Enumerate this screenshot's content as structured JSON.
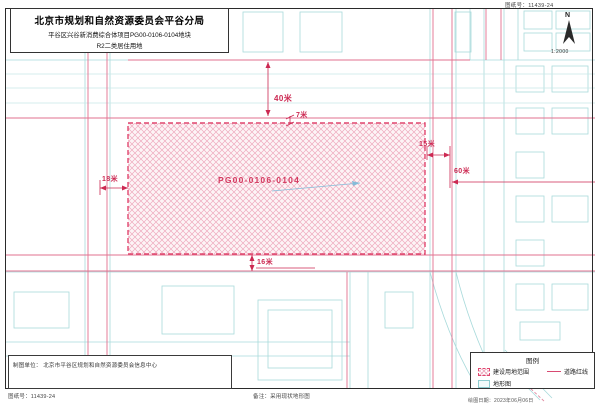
{
  "document": {
    "sheet_no_top": "图纸号：11439-24",
    "title_block": {
      "line1": "北京市规划和自然资源委员会平谷分局",
      "line2": "平谷区兴谷新消费综合体项目PG00-0106-0104地块",
      "line3": "R2二类居住用地"
    },
    "north": {
      "label": "N",
      "scale": "1:2000"
    },
    "map": {
      "parcel_label": "PG00-0106-0104",
      "dimensions": {
        "road_top_width": "40米",
        "strip_top": "7米",
        "road_right_width": "15米",
        "offset_right": "60米",
        "road_left_width": "18米",
        "road_bottom_width": "16米"
      }
    },
    "legend": {
      "title": "图例",
      "items": [
        {
          "label": "建设用地范围"
        },
        {
          "label": "道路红线"
        },
        {
          "label": "地形图"
        }
      ]
    },
    "info_box_text": "制图单位： 北京市平谷区规划和自然资源委员会信息中心",
    "footer": {
      "sheet_no": "图纸号：11439-24",
      "note": "备注：采用现状地形图",
      "date": "绘图日期：2023年06月06日"
    },
    "colors": {
      "parcel_outline": "#e0476f",
      "parcel_hatch": "#eeaabe",
      "road_redline": "#e2718f",
      "topo_cyan": "#a8dadb",
      "dimension_red": "#cc2952"
    }
  }
}
